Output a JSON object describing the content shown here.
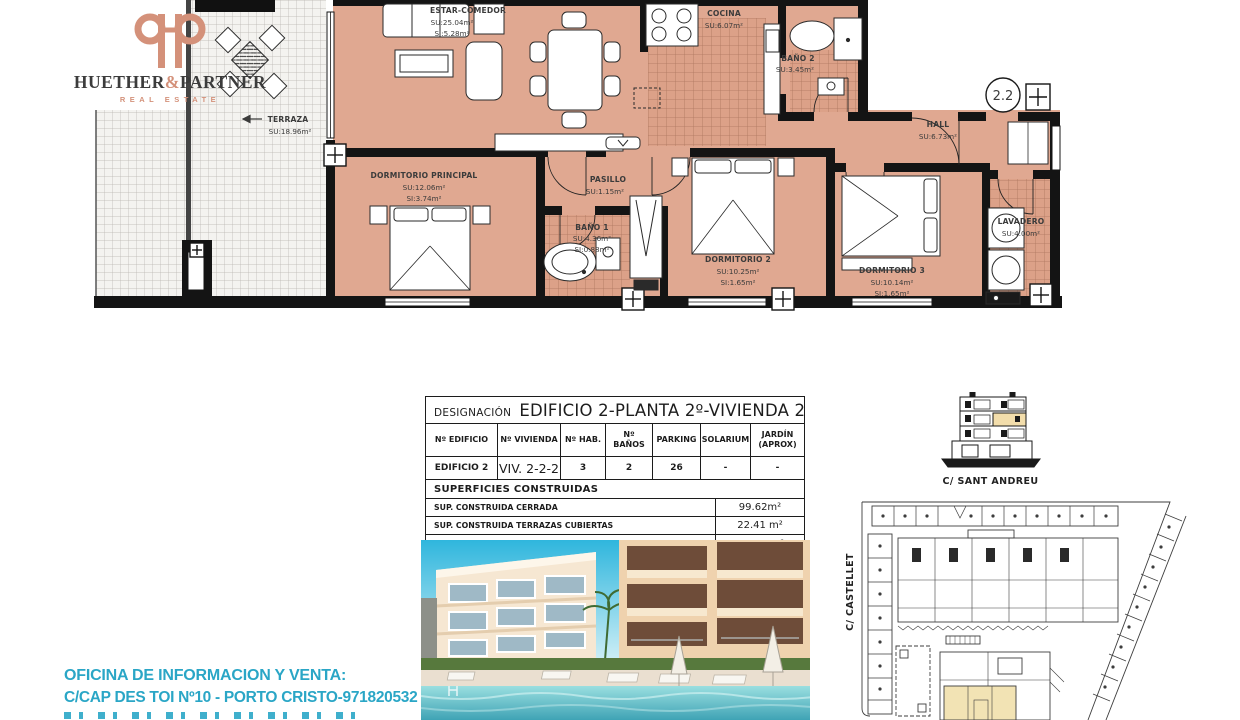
{
  "brand": {
    "name_left": "HUETHER",
    "ampersand": "&",
    "name_right": "PARTNER",
    "tagline": "REAL ESTATE"
  },
  "floorplan": {
    "unit_badge": "2.2",
    "rooms": {
      "estar_comedor": {
        "name": "ESTAR-COMEDOR",
        "su": "SU:25.04m²",
        "si": "SI:5.28m²"
      },
      "cocina": {
        "name": "COCINA",
        "su": "SU:6.07m²"
      },
      "bano2": {
        "name": "BAÑO 2",
        "su": "SU:3.45m²"
      },
      "hall": {
        "name": "HALL",
        "su": "SU:6.73m²"
      },
      "terraza": {
        "name": "TERRAZA",
        "su": "SU:18.96m²"
      },
      "dormitorio_principal": {
        "name": "DORMITORIO PRINCIPAL",
        "su": "SU:12.06m²",
        "si": "SI:3.74m²"
      },
      "pasillo": {
        "name": "PASILLO",
        "su": "SU:1.15m²"
      },
      "bano1": {
        "name": "BAÑO 1",
        "su": "SU:4.36m²",
        "si": "SI:0.88m²"
      },
      "dormitorio2": {
        "name": "DORMITORIO 2",
        "su": "SU:10.25m²",
        "si": "SI:1.65m²"
      },
      "dormitorio3": {
        "name": "DORMITORIO 3",
        "su": "SU:10.14m²",
        "si": "SI:1.65m²"
      },
      "lavadero": {
        "name": "LAVADERO",
        "su": "SU:4.00m²"
      }
    }
  },
  "spec_table": {
    "designation_label": "DESIGNACIÓN",
    "designation_value": "EDIFICIO 2-PLANTA 2º-VIVIENDA 2",
    "columns": [
      "Nº EDIFICIO",
      "Nº VIVIENDA",
      "Nº HAB.",
      "Nº BAÑOS",
      "PARKING",
      "SOLARIUM",
      "JARDÍN (APROX)"
    ],
    "row": [
      "EDIFICIO 2",
      "VIV. 2-2-2",
      "3",
      "2",
      "26",
      "-",
      "-"
    ],
    "surfaces_title": "SUPERFICIES CONSTRUIDAS",
    "surfaces": [
      {
        "label": "SUP. CONSTRUIDA CERRADA",
        "value": "99.62m²"
      },
      {
        "label": "SUP. CONSTRUIDA TERRAZAS CUBIERTAS",
        "value": "22.41 m²"
      },
      {
        "label": "TOTAL SUPERFICIE CONSTRUIDA",
        "value": "122.03m²"
      }
    ]
  },
  "site": {
    "street_top": "C/ SANT ANDREU",
    "street_left": "C/ CASTELLET"
  },
  "office": {
    "line1": "OFICINA DE INFORMACION Y VENTA:",
    "line2": "C/CAP DES TOI Nº10 - PORTO CRISTO-971820532"
  },
  "colors": {
    "brand_salmon": "#d4917a",
    "floor_salmon": "#e0a891",
    "tile_line": "#9c6650",
    "wall": "#141414",
    "teal_text": "#2aa6c6",
    "unit_highlight": "#f2e3b4"
  }
}
